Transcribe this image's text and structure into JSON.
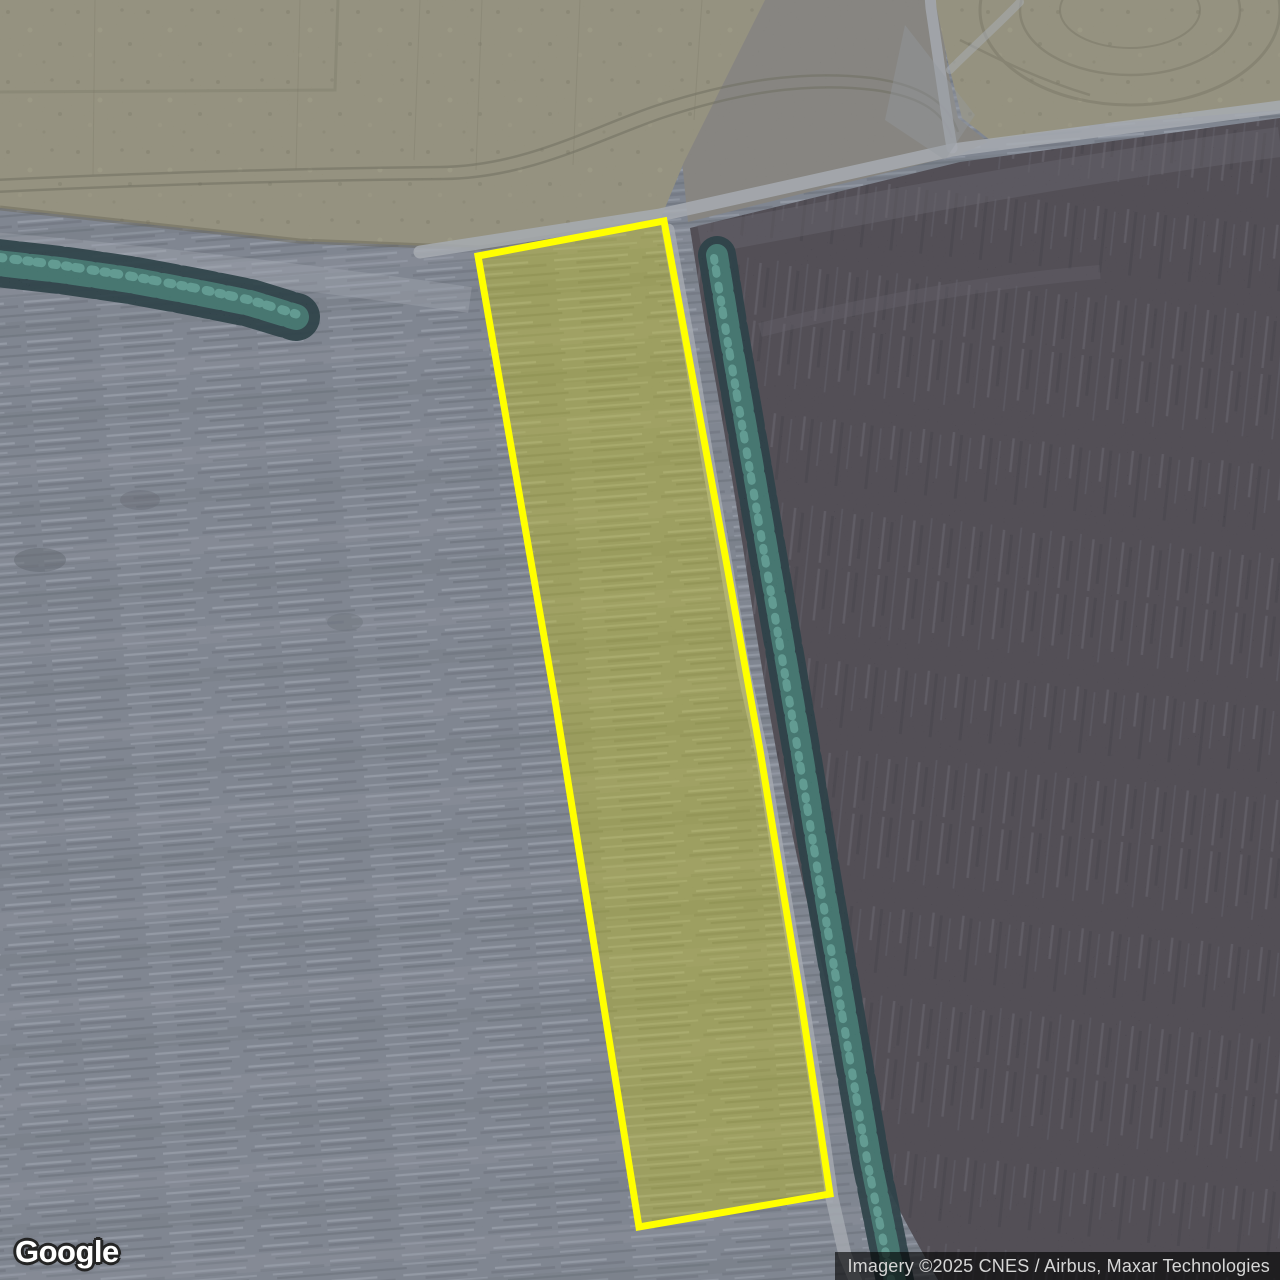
{
  "map_view": {
    "kind": "satellite-imagery",
    "logo_text": "Google",
    "attribution_text": "Imagery ©2025 CNES / Airbus, Maxar Technologies"
  },
  "highlight": {
    "label": "highlighted field parcel",
    "points": "478,256 664,221 726,560 760,750 801,1000 830,1194 639,1227 555,700",
    "fill_color": "rgba(215,210,0,0.33)",
    "stroke_color": "#ffff00",
    "stroke_width": 7
  },
  "palette": {
    "plowed_field_gray": "#747b88",
    "dark_field_purple": "#3b363e",
    "stubble_field_tan": "#8e8a72",
    "tree_line_teal": "#2e6b63",
    "road_gray": "#a4a9b0",
    "highlight_yellow": "#ffff00"
  }
}
